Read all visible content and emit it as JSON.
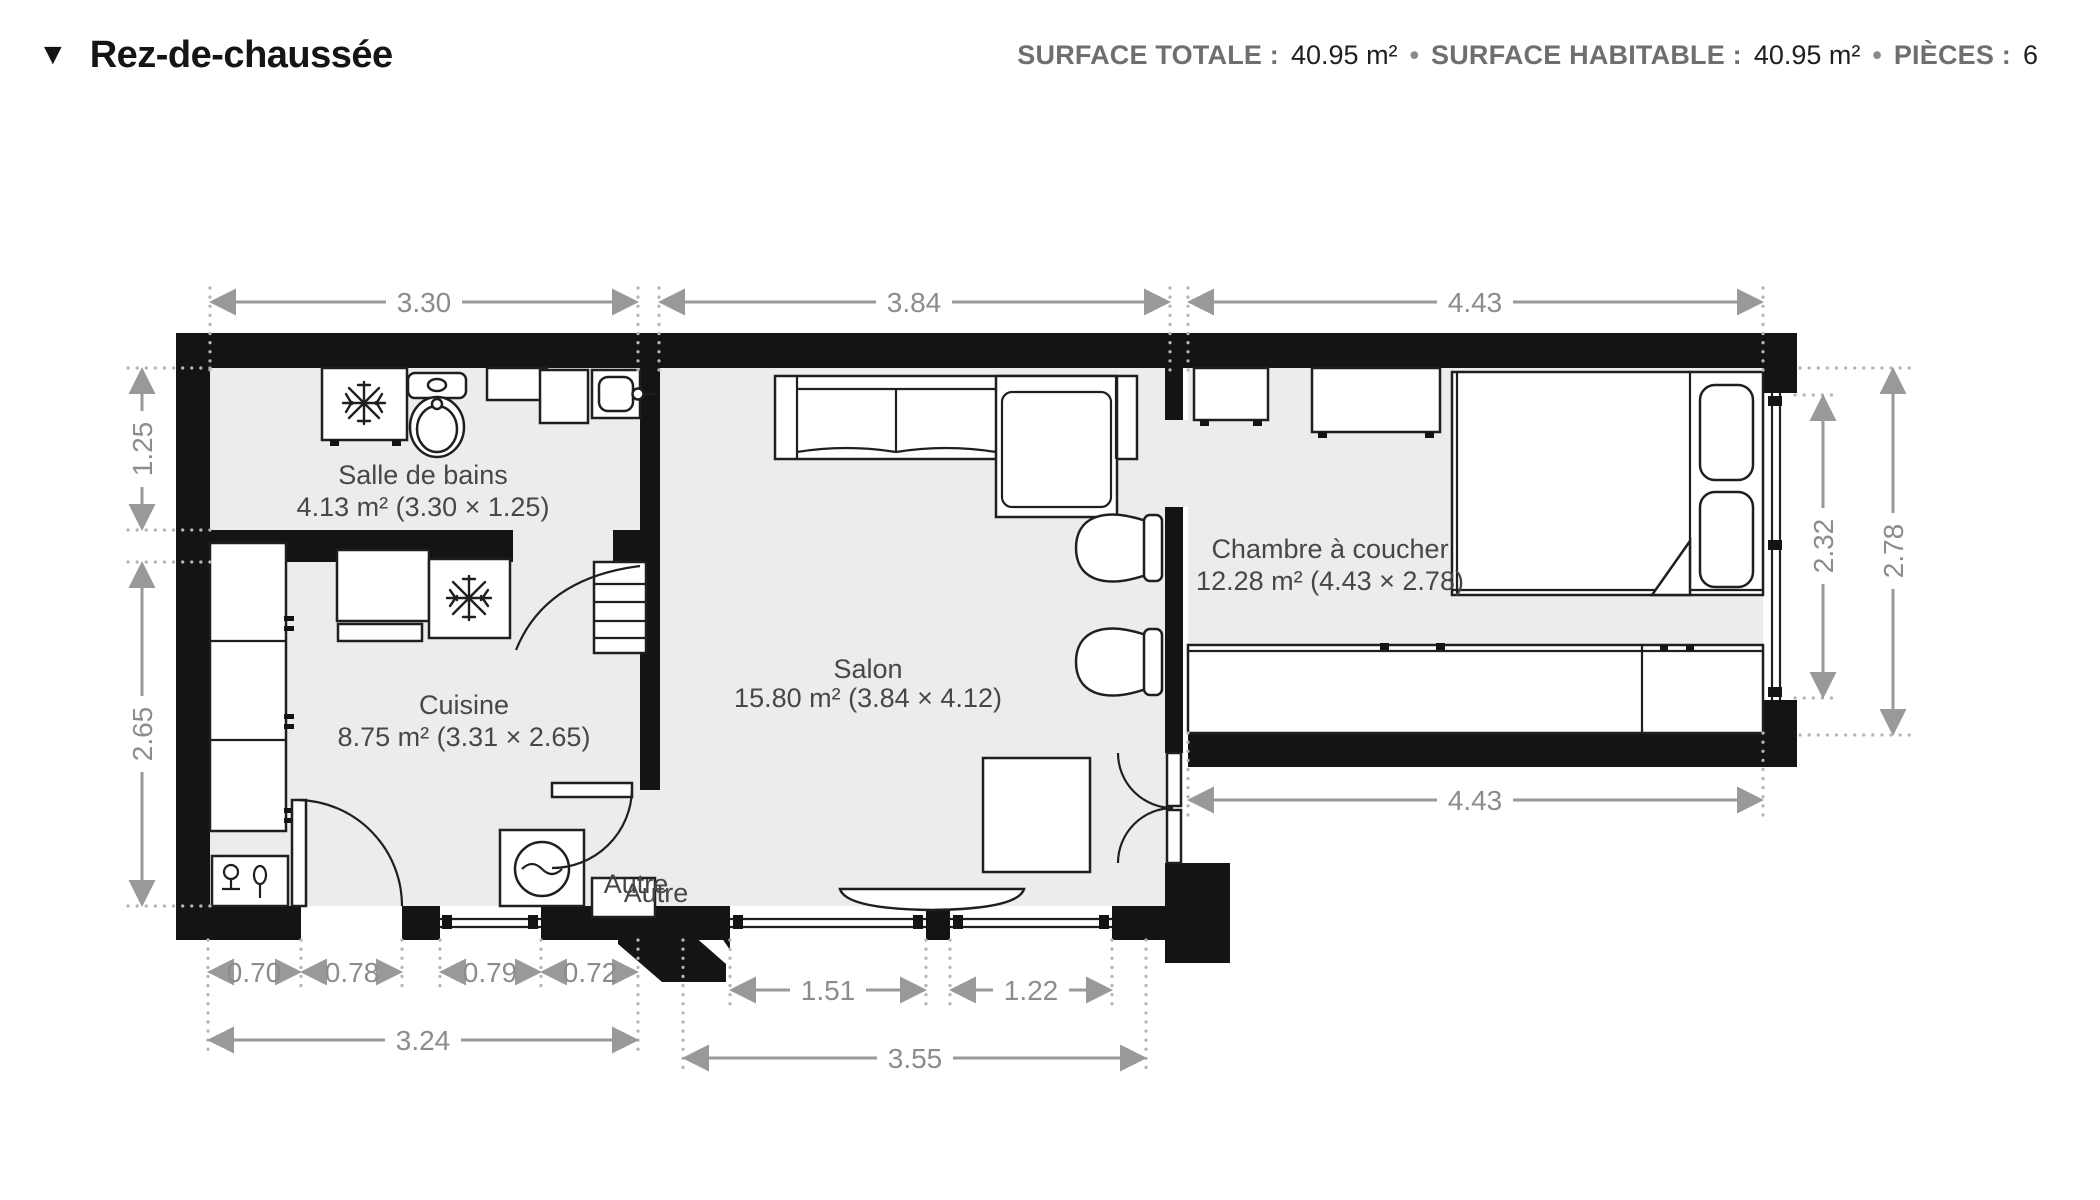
{
  "header": {
    "icon": "▼",
    "title": "Rez-de-chaussée",
    "sep": "•",
    "stats": [
      {
        "label": "SURFACE TOTALE :",
        "value": "40.95 m²"
      },
      {
        "label": "SURFACE HABITABLE :",
        "value": "40.95 m²"
      },
      {
        "label": "PIÈCES :",
        "value": "6"
      }
    ]
  },
  "rooms": [
    {
      "name": "Salle de bains",
      "details": "4.13 m² (3.30 × 1.25)"
    },
    {
      "name": "Cuisine",
      "details": "8.75 m² (3.31 × 2.65)"
    },
    {
      "name": "Salon",
      "details": "15.80 m² (3.84 × 4.12)"
    },
    {
      "name": "Chambre à coucher",
      "details": "12.28 m² (4.43 × 2.78)"
    },
    {
      "name": "Autre"
    },
    {
      "name": "Autre"
    }
  ],
  "dims": {
    "bath_top": "3.30",
    "salon_top": "3.84",
    "bed_top": "4.43",
    "bath_left": "1.25",
    "kitchen_left": "2.65",
    "k1": "0.70",
    "k2": "0.78",
    "k3": "0.79",
    "k4": "0.72",
    "kitchen_total": "3.24",
    "s1": "1.51",
    "s2": "1.22",
    "salon_total": "3.55",
    "bed_bottom": "4.43",
    "bed_window": "2.32",
    "bed_right": "2.78"
  },
  "colors": {
    "wall": "#141414",
    "floor": "#ececec",
    "dimension": "#999999",
    "label": "#474747"
  }
}
